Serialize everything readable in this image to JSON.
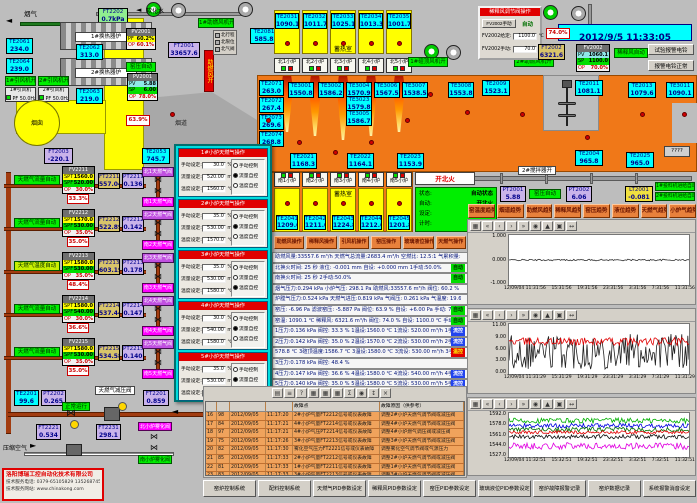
{
  "window": {
    "datetime": "2012/9/5 11:33:05",
    "bell_test": "试验报警电铃",
    "bell_ok": "报警电铃正常"
  },
  "colors": {
    "furnace": "#f07818",
    "regenerator": "#ffff00",
    "sensor": "#00ffff",
    "alarm_row": "#f0a35c",
    "auto_green": "#00ee00"
  },
  "tl": {
    "flue_gas": "烟气",
    "soft_water": "软化水",
    "ft2202": {
      "t": "FT2202",
      "v": "0.7kPa"
    },
    "hx1": "1#换热器炉",
    "hx2": "2#换热器炉",
    "te2061": {
      "t": "TE2061",
      "v": "234.0"
    },
    "te2064": {
      "t": "TE2064",
      "v": "239.0"
    },
    "te2062": {
      "t": "TE2062",
      "v": "313.0"
    },
    "te2063": {
      "t": "TE2063",
      "v": "219.0"
    },
    "fan1_on": "1#引风机开",
    "fan2_on": "2#引风机开",
    "fan1": {
      "name": "1#引风机",
      "pf": "PF 50.0Hz"
    },
    "fan2": {
      "name": "2#引风机",
      "pf": "PF 50.0Hz"
    },
    "chimney": "烟囱",
    "ft2003": {
      "t": "FT2003",
      "v": "-220.1"
    },
    "damper": {
      "t": "PV2001",
      "r1": "PF",
      "v1": "60.2%",
      "r2": "OP",
      "v2": "60.1%"
    },
    "ft2001": {
      "t": "FT2001",
      "v": "33657.6"
    },
    "kp_auto": "窑压自动",
    "pv2001": {
      "t": "PV2001",
      "r1": "PV",
      "v1": "5.88",
      "r2": "SP",
      "v2": "6.00",
      "r3": "OP",
      "v3": "78.0%"
    },
    "damper_pos": "63.9%",
    "flue": "烟道",
    "te2053": {
      "t": "TE2053",
      "v": "745.7"
    },
    "te2081": {
      "t": "TE2081",
      "v": "585.8"
    },
    "comb_fan_open": "助燃风开",
    "comb_fan1_on": "1#助燃风机开",
    "legend": [
      {
        "label": "北行程",
        "c": "#b0b0b0"
      },
      {
        "label": "北限位",
        "c": "#b0b0b0"
      },
      {
        "label": "北气阀",
        "c": "#00d000"
      }
    ]
  },
  "north": {
    "title": "蓄热室",
    "cells": [
      {
        "t": "TE2031",
        "v": "1090.1"
      },
      {
        "t": "TE2032",
        "v": "1011.7"
      },
      {
        "t": "TE2033",
        "v": "1025.1"
      },
      {
        "t": "TE2034",
        "v": "1013.3"
      },
      {
        "t": "TE2035",
        "v": "1001.7"
      }
    ],
    "furnaces": [
      {
        "label": "北1小炉"
      },
      {
        "label": "北2小炉"
      },
      {
        "label": "北3小炉"
      },
      {
        "label": "北4小炉"
      },
      {
        "label": "北5小炉"
      }
    ],
    "crown_fan_on": "1#碹顶风机开",
    "comb_fan2_on": "2#助燃风机开"
  },
  "sens": {
    "te3001": {
      "t": "TE3001",
      "v": "1550.8"
    },
    "te3002": {
      "t": "TE3002",
      "v": "1586.2"
    },
    "te3004": {
      "t": "TE3004",
      "v": "1570.9"
    },
    "te3023": {
      "t": "TE3023",
      "v": "1579.8"
    },
    "te3005": {
      "t": "TE3005",
      "v": "1586.7"
    },
    "te3006": {
      "t": "TE3006",
      "v": "1567.5"
    },
    "te3007": {
      "t": "TE3007",
      "v": "1538.5"
    },
    "te3008": {
      "t": "TE3008",
      "v": "1553.8"
    },
    "te2009": {
      "t": "TE2009",
      "v": "1523.1"
    },
    "te2011": {
      "t": "TE2011",
      "v": "1081.1"
    },
    "te2013": {
      "t": "TE2013",
      "v": "1079.6"
    },
    "te3011": {
      "t": "TE3011",
      "v": "1090.1"
    },
    "te2004": {
      "t": "TE2004",
      "v": "965.8"
    },
    "te2025": {
      "t": "TE2025",
      "v": "965.0"
    },
    "te2071": {
      "t": "TE2071",
      "v": "263.0"
    },
    "te2072": {
      "t": "TE2072",
      "v": "267.4"
    },
    "te2073": {
      "t": "TE2073",
      "v": "269.6"
    },
    "te2074": {
      "t": "TE2074",
      "v": "268.8"
    },
    "te2021": {
      "t": "TE2021",
      "v": "1168.3"
    },
    "te2022": {
      "t": "TE2022",
      "v": "1164.1"
    },
    "te2023": {
      "t": "TE2023",
      "v": "1153.9"
    },
    "unknown": "????"
  },
  "south": {
    "furnaces": [
      {
        "label": "南1小炉"
      },
      {
        "label": "南2小炉"
      },
      {
        "label": "南3小炉"
      },
      {
        "label": "南4小炉"
      },
      {
        "label": "南5小炉"
      }
    ],
    "title": "蓄热室",
    "cells": [
      {
        "t": "TE2041",
        "v": "1209.6"
      },
      {
        "t": "TE2042",
        "v": "1211.0"
      },
      {
        "t": "TE2043",
        "v": "1224.8"
      },
      {
        "t": "TE2044",
        "v": "1212.6"
      },
      {
        "t": "TE2045",
        "v": "1201.8"
      }
    ],
    "fire_mode": "开北火",
    "status": [
      {
        "k": "状态:",
        "v": "自动状态"
      },
      {
        "k": "自动:",
        "v": "开北火"
      },
      {
        "k": "设定:",
        "v": "1175 秒"
      },
      {
        "k": "计时:",
        "v": "269 秒"
      }
    ],
    "stirrer_on": "2#搅拌器开"
  },
  "mid": {
    "pt2001": {
      "t": "PT2001",
      "v": "5.88"
    },
    "kp_auto": "窑压自动",
    "pt2002": {
      "t": "PT2002",
      "v": "6.06"
    },
    "lt2001": {
      "t": "LT2001",
      "v": "-0.081"
    },
    "feeder1": "1#投料机进给自动",
    "feeder2": "2#投料机进给自动"
  },
  "dilution": {
    "title": "稀释风调节阀操作",
    "manual_btn": "FV2002手动",
    "auto": "自动",
    "f1": "FV2002给定:",
    "v1": "1100.0",
    "u1": "℃",
    "f2": "FV2002手动:",
    "v2": "70.0",
    "u2": "%",
    "fv2002": {
      "t": "FV2002",
      "r1": "PV",
      "v1": "1060.1",
      "r2": "SP",
      "v2": "1100.0",
      "r3": "OP",
      "v3": "70.0%"
    },
    "auto_label": "稀释风自动",
    "pos": "74.0%",
    "ft2002": {
      "t": "FT2002",
      "v": "6321.6"
    }
  },
  "trend_buttons": [
    {
      "label": "窑温度趋势"
    },
    {
      "label": "烟道趋势"
    },
    {
      "label": "助燃风趋势"
    },
    {
      "label": "稀释风趋势"
    },
    {
      "label": "窑压趋势"
    },
    {
      "label": "液位趋势"
    },
    {
      "label": "天燃气趋势"
    },
    {
      "label": "小炉气趋势"
    }
  ],
  "ops_buttons": [
    {
      "label": "助燃风操作"
    },
    {
      "label": "稀释风操作"
    },
    {
      "label": "引风机操作"
    },
    {
      "label": "窑压操作"
    },
    {
      "label": "玻璃液位操作"
    },
    {
      "label": "天燃气操作"
    }
  ],
  "stats": {
    "lines": [
      {
        "text": "助燃风量:33557.6 m³/h  天燃气总流量:2683.4 m³/h  空燃比: 12.5:1  气累积量: 134057.7 m³"
      },
      {
        "text": "北换火时间:  25 秒    液位: -0.001 mm   自设: +0.000 mm   1手动:50.0%",
        "tag": "自动",
        "tagc": "g"
      },
      {
        "text": "南换火时间:  25 秒    2手动:50.0%",
        "tag": "自动",
        "tagc": "g"
      },
      {
        "text": "烟气压力:0.294 kPa  小炉气压: 298.1 Pa  助燃风:33557.6 m³/h 阀位: 60.2 % 设定: 60.0 %"
      },
      {
        "text": "炉膛气压力:0.524 kPa   天燃气进压:0.819 kPa   气阀压: 0.261 kPa   气温度: 19.6 ℃"
      },
      {
        "text": "窑压: -6.96 Pa  滤波窑压: -5.887 Pa  阀位: 63.9 %  自设: +6.00 Pa  手动: 70.0 %",
        "tag": "自动",
        "tagc": "g"
      },
      {
        "text": "窑温: 1090.1 ℃  稀释风: 6321.6 m³/h  阀位: 74.0 %  自设: 1100.0 ℃  手动: 70.0 %",
        "tag": "自动",
        "tagc": "g"
      },
      {
        "text": "1压力:0.136 kPa 阀控: 33.3 % 1温设:1560.0 ℃ 1流设: 520.00 m³/h 1手动: 30.0 %",
        "tag": "流控",
        "tagc": "b"
      },
      {
        "text": "2压力:0.142 kPa 阀控: 35.0 % 2温设:1570.0 ℃ 2流设: 530.00 m³/h 2手动: 35.0 %",
        "tag": "流控",
        "tagc": "b"
      },
      {
        "text": "578.8 ℃  3碹顶温度:1586.7 ℃  3温设:1580.0 ℃ 3流设: 530.00 m³/h 3手动: 35.0 %",
        "tag": "温控",
        "tagc": "r"
      },
      {
        "text": "3压力:0.178 kPa 阀控: 48.4 %"
      },
      {
        "text": "4压力:0.147 kPa 阀控: 36.6 % 4温设:1580.0 ℃ 4流设: 540.00 m³/h 4手动: 30.0 %",
        "tag": "流控",
        "tagc": "b"
      },
      {
        "text": "5压力:0.140 kPa 阀控: 35.0 % 5温设:1580.0 ℃ 5流设: 530.00 m³/h 5手动: 35.0 %",
        "tag": "流控",
        "tagc": "b"
      }
    ]
  },
  "popup": {
    "fields": {
      "manual": "手动设定:",
      "flow": "流量设定:",
      "temp": "温度设定:",
      "u_manual": "%",
      "u_flow": "m³/h",
      "u_temp": "℃"
    },
    "radio_options": [
      "手动控制",
      "流量自控",
      "温度自控"
    ],
    "panels": [
      {
        "title": "1#小炉天燃气操作",
        "manual": "30.0",
        "flow": "520.00",
        "temp": "1560.0",
        "selected": 1
      },
      {
        "title": "2#小炉天燃气操作",
        "manual": "35.0",
        "flow": "530.00",
        "temp": "1570.0",
        "selected": 1
      },
      {
        "title": "3#小炉天燃气操作",
        "manual": "35.0",
        "flow": "530.00",
        "temp": "1580.0",
        "selected": 2
      },
      {
        "title": "4#小炉天燃气操作",
        "manual": "30.0",
        "flow": "540.00",
        "temp": "1580.0",
        "selected": 1
      },
      {
        "title": "5#小炉天燃气操作",
        "manual": "35.0",
        "flow": "530.00",
        "temp": "1580.0",
        "selected": 1
      }
    ]
  },
  "gas": {
    "labels": {
      "spt": "SPT",
      "spf": "SPF",
      "op": "OP"
    },
    "loops": [
      {
        "mode": "天燃气流量自动",
        "mode_type": "flow",
        "fv": "FV2211",
        "spt": "1560.0",
        "spf": "520.00",
        "op": "30.0%",
        "ft_t": "FT2211",
        "ft_v": "557.04",
        "pt_t": "PT2211",
        "pt_v": "0.136",
        "pct": "33.3%",
        "vtop": "北1天燃气阀",
        "vbot": "南1天燃气阀"
      },
      {
        "mode": "天燃气流量自动",
        "mode_type": "flow",
        "fv": "FV2212",
        "spt": "1570.0",
        "spf": "530.00",
        "op": "35.0%",
        "ft_t": "FT2212",
        "ft_v": "522.89",
        "pt_t": "PT2212",
        "pt_v": "0.142",
        "pct": "35.0%",
        "vtop": "北2天燃气阀",
        "vbot": "南2天燃气阀"
      },
      {
        "mode": "天燃气温度自动",
        "mode_type": "temp",
        "fv": "FV2213",
        "spt": "1580.0",
        "spf": "530.00",
        "op": "35.0%",
        "ft_t": "FT2213",
        "ft_v": "603.19",
        "pt_t": "PT2213",
        "pt_v": "0.178",
        "pct": "48.4%",
        "vtop": "北3天燃气阀",
        "vbot": "南3天燃气阀"
      },
      {
        "mode": "天燃气流量自动",
        "mode_type": "flow",
        "fv": "FV2214",
        "spt": "1580.0",
        "spf": "540.00",
        "op": "30.0%",
        "ft_t": "FT2214",
        "ft_v": "537.44",
        "pt_t": "PT2214",
        "pt_v": "0.147",
        "pct": "36.6%",
        "vtop": "北4天燃气阀",
        "vbot": "南4天燃气阀"
      },
      {
        "mode": "天燃气流量自动",
        "mode_type": "flow",
        "fv": "FV2215",
        "spt": "1580.0",
        "spf": "530.00",
        "op": "35.0%",
        "ft_t": "FT2215",
        "ft_v": "534.58",
        "pt_t": "PT2215",
        "pt_v": "0.140",
        "pct": "35.0%",
        "vtop": "北5天燃气阀",
        "vbot": "南5天燃气阀"
      }
    ],
    "te2201": {
      "t": "TE2201",
      "v": "99.6"
    },
    "pt2202": {
      "t": "PT2202",
      "v": "0.265"
    },
    "pr_valve": "天燃气减压阀",
    "run_ok": "正常运行",
    "ft2201": {
      "t": "FT2201",
      "v": "0.859"
    },
    "air": "压缩空气",
    "ft2221": {
      "t": "FT2221",
      "v": "0.534"
    },
    "ft2231": {
      "t": "FT2231",
      "v": "298.1"
    },
    "air_vtop": "北小炉雾化阀",
    "air_vbot": "南小炉雾化阀"
  },
  "alarm": {
    "toolbar": [
      {
        "g": "▤"
      },
      {
        "g": "≡"
      },
      {
        "g": "?"
      },
      {
        "g": "▦"
      },
      {
        "g": "▦"
      },
      {
        "g": "▦"
      },
      {
        "g": "Σ"
      },
      {
        "g": "◉"
      },
      {
        "g": "↕"
      },
      {
        "g": "×"
      }
    ],
    "headers": {
      "fault": "故障点",
      "cause": "故障原因（供参考）"
    },
    "rows": [
      {
        "n": "16",
        "id": "98",
        "date": "2012/09/05",
        "time": "11:17:20",
        "fault": "2#小炉气量FT2212信号或仪表故障",
        "cause": "调整2#小炉天燃气调节阀或减压阀"
      },
      {
        "n": "17",
        "id": "84",
        "date": "2012/09/05",
        "time": "11:17:21",
        "fault": "4#小炉气量FT2214信号或仪表故障",
        "cause": "调整4#小炉天燃气调节阀或减压阀"
      },
      {
        "n": "18",
        "id": "97",
        "date": "2012/09/05",
        "time": "11:17:21",
        "fault": "4#小炉气压PT2214信号或仪表故障",
        "cause": "调整4#小炉燃气调压阀或减压阀"
      },
      {
        "n": "19",
        "id": "75",
        "date": "2012/09/05",
        "time": "11:17:26",
        "fault": "3#小炉气量FT2213信号或仪表故障",
        "cause": "调整3#小炉天燃气调节阀或减压阀"
      },
      {
        "n": "20",
        "id": "82",
        "date": "2012/09/05",
        "time": "11:17:30",
        "fault": "雾化空气压力FT2221信号或仪表故障",
        "cause": "调整雾化空气调节阀或气源压力"
      },
      {
        "n": "21",
        "id": "85",
        "date": "2012/09/05",
        "time": "11:17:33",
        "fault": "2#小炉气量FT2212信号或仪表故障",
        "cause": "调整2#小炉天燃气调节阀或减压阀"
      },
      {
        "n": "22",
        "id": "81",
        "date": "2012/09/05",
        "time": "11:17:33",
        "fault": "1#小炉气量FT2211信号或仪表故障",
        "cause": "调整1#小炉天燃气调节阀或减压阀"
      },
      {
        "n": "23",
        "id": "83",
        "date": "2012/09/05",
        "time": "11:17:33",
        "fault": "3#小炉气量FT2213信号或仪表故障",
        "cause": "调整3#小炉天燃气调节阀或减压阀"
      }
    ]
  },
  "trends": {
    "toolbar": [
      {
        "g": "▦"
      },
      {
        "g": "«"
      },
      {
        "g": "‹"
      },
      {
        "g": "›"
      },
      {
        "g": "»"
      },
      {
        "g": "◉"
      },
      {
        "g": "▲"
      },
      {
        "g": "▣"
      },
      {
        "g": "↔"
      }
    ],
    "charts": [
      {
        "ymin": -1.3,
        "ymax": 1.3,
        "yticks": [
          "1.000",
          "0.000",
          "-1.000"
        ],
        "xticks": [
          "12/09/04 11:31:56",
          "15:31:56",
          "19:31:56",
          "23:31:56",
          "3:31:56",
          "7:31:56",
          "11:31:56"
        ],
        "series": [
          {
            "color": "#303030",
            "level": 0,
            "noise": 0.04
          }
        ]
      },
      {
        "ymin": -0.5,
        "ymax": 12,
        "yticks": [
          "11.00",
          "9.00",
          "6.00",
          "3.00",
          "0.00"
        ],
        "xticks": [
          "12/09/04 11:31:29",
          "15:31:29",
          "19:31:29",
          "23:31:29",
          "3:31:29",
          "7:31:29",
          "11:31:29"
        ],
        "series": [
          {
            "color": "#202020",
            "level": 5.2,
            "noise": 4.5
          },
          {
            "color": "#e00000",
            "level": 7.6,
            "noise": 1.0
          }
        ]
      },
      {
        "ymin": 1520,
        "ymax": 1600,
        "yticks": [
          "1592.0",
          "1578.0",
          "1561.0",
          "1544.0",
          "1527.0"
        ],
        "xticks": [
          "12/09/04 11:32:51",
          "15:32:51",
          "19:32:51",
          "23:32:51",
          "3:32:51",
          "7:32:51",
          "11:32:51"
        ],
        "series": [
          {
            "color": "#00b000",
            "level": 1586,
            "noise": 5
          },
          {
            "color": "#0000e0",
            "level": 1577,
            "noise": 4
          },
          {
            "color": "#007000",
            "level": 1570,
            "noise": 4
          },
          {
            "color": "#e00000",
            "level": 1565,
            "noise": 3
          },
          {
            "color": "#101010",
            "level": 1557,
            "noise": 4
          },
          {
            "color": "#e000e0",
            "level": 1540,
            "noise": 6
          }
        ]
      }
    ]
  },
  "bottom_buttons": [
    {
      "label": "窑炉控制系统"
    },
    {
      "label": "配料控制系统"
    },
    {
      "label": "天燃气PID参数设定"
    },
    {
      "label": "稀释风PID参数设定"
    },
    {
      "label": "窑压PID参数设定"
    },
    {
      "label": "玻璃液位PID参数设定"
    },
    {
      "label": "窑炉故障报警记录"
    },
    {
      "label": "窑炉数据记录"
    },
    {
      "label": "系统报警消音设定"
    }
  ],
  "company": {
    "name": "洛阳博瑞工控自动化技术有限公司",
    "phone": "技术服务电话: 0379-65105829  13526874529",
    "web": "技术服务网站: www.chinakong.com"
  }
}
